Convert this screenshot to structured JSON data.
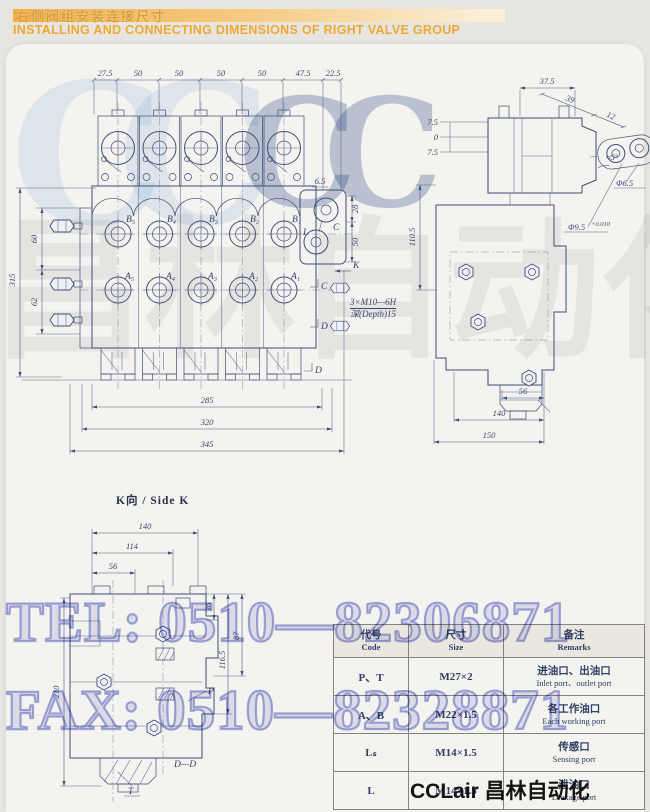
{
  "header": {
    "title_zh": "右侧阀组安装连接尺寸",
    "title_en": "INSTALLING AND CONNECTING DIMENSIONS OF RIGHT VALVE GROUP"
  },
  "watermark": {
    "tel": "TEL: 0510—82306871",
    "fax": "FAX: 0510—82328871",
    "logo_letters": "CC",
    "gray_text": "昌林自动化"
  },
  "front": {
    "dims_top": [
      "27.5",
      "50",
      "50",
      "50",
      "50",
      "47.5",
      "22.5"
    ],
    "dim_total_h": "315",
    "dim_60": "60",
    "dim_62": "62",
    "dims_bottom": [
      "285",
      "320",
      "345"
    ],
    "ports_b": [
      "B₅",
      "B₄",
      "B₃",
      "B₂",
      "B₁"
    ],
    "ports_a": [
      "A₅",
      "A₄",
      "A₃",
      "A₂",
      "A₁"
    ],
    "end_d65": "6.5",
    "end_d28": "28",
    "end_d50": "50",
    "end_c": "C",
    "end_l": "L",
    "marker_k": "K",
    "marker_c": "C",
    "marker_d1": "D",
    "marker_d2": "D",
    "note1": "3×M10—6H",
    "note2": "深(Depth)15"
  },
  "side": {
    "dim_375": "37.5",
    "dim_39": "39",
    "dim_12": "12",
    "angle": "≈5°",
    "dia_65": "Φ6.5",
    "dia_95": "Φ9.5",
    "dia_95_tol": "+0.010",
    "dim_75a": "7.5",
    "dim_0": "0",
    "dim_75b": "7.5",
    "dim_1105": "110.5",
    "dim_56": "56",
    "dim_140": "140",
    "dim_150": "150"
  },
  "kview": {
    "title": "K向 / Side K",
    "dim_140": "140",
    "dim_114": "114",
    "dim_56": "56",
    "dim_210": "210",
    "dim_36": "36",
    "dim_87": "87",
    "dim_1165": "116.5",
    "label_p": "P",
    "label_dd": "D—D",
    "label_t": "T"
  },
  "port_table": {
    "headers": [
      {
        "zh": "代号",
        "en": "Code"
      },
      {
        "zh": "尺寸",
        "en": "Size"
      },
      {
        "zh": "备注",
        "en": "Remarks"
      }
    ],
    "rows": [
      {
        "code": "P、T",
        "size": "M27×2",
        "zh": "进油口、出油口",
        "en": "Inlet port、outlet port"
      },
      {
        "code": "A、B",
        "size": "M22×1.5",
        "zh": "各工作油口",
        "en": "Each working port"
      },
      {
        "code": "Lₛ",
        "size": "M14×1.5",
        "zh": "传感口",
        "en": "Sensing port"
      },
      {
        "code": "L",
        "size": "M14×1.5",
        "zh": "泄油口",
        "en": "Leakage port"
      }
    ]
  },
  "footer": {
    "brand": "CCLair 昌林自动化"
  }
}
